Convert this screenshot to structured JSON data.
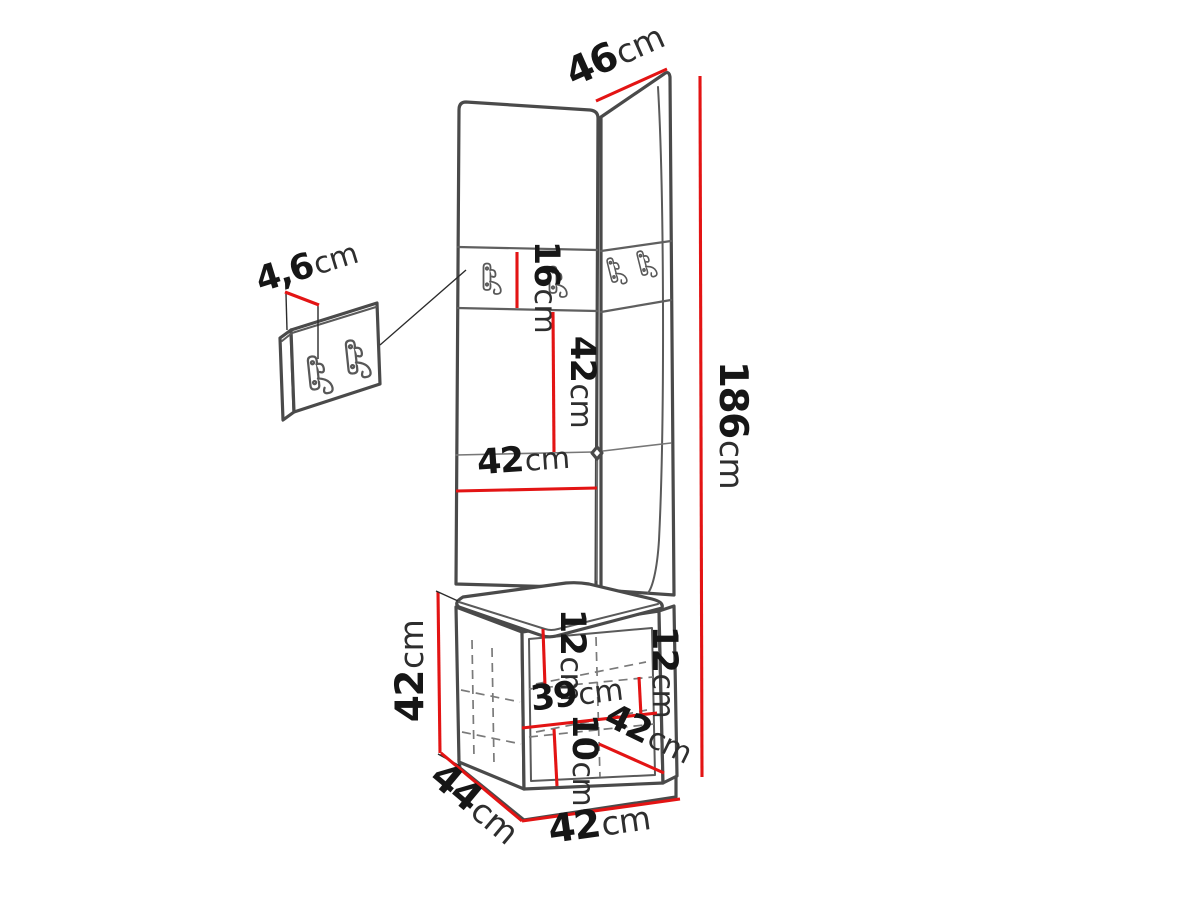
{
  "diagram": {
    "subject": "corner hallway furniture dimension drawing",
    "accent_color": "#e31414",
    "line_color": "#4a4a4a",
    "dims": {
      "top_width": {
        "num": "46",
        "unit": "cm"
      },
      "height": {
        "num": "186",
        "unit": "cm"
      },
      "rail_height": {
        "num": "16",
        "unit": "cm"
      },
      "upper_panel": {
        "num": "42",
        "unit": "cm"
      },
      "panel_width": {
        "num": "42",
        "unit": "cm"
      },
      "rail_thickness": {
        "num": "4,6",
        "unit": "cm"
      },
      "bench_height": {
        "num": "42",
        "unit": "cm"
      },
      "inner_top_left": {
        "num": "12",
        "unit": "cm"
      },
      "inner_top_right": {
        "num": "12",
        "unit": "cm"
      },
      "inner_width": {
        "num": "39",
        "unit": "cm"
      },
      "inner_bottom": {
        "num": "10",
        "unit": "cm"
      },
      "seat_depth": {
        "num": "42",
        "unit": "cm"
      },
      "base_depth": {
        "num": "44",
        "unit": "cm"
      },
      "base_width": {
        "num": "42",
        "unit": "cm"
      }
    }
  }
}
